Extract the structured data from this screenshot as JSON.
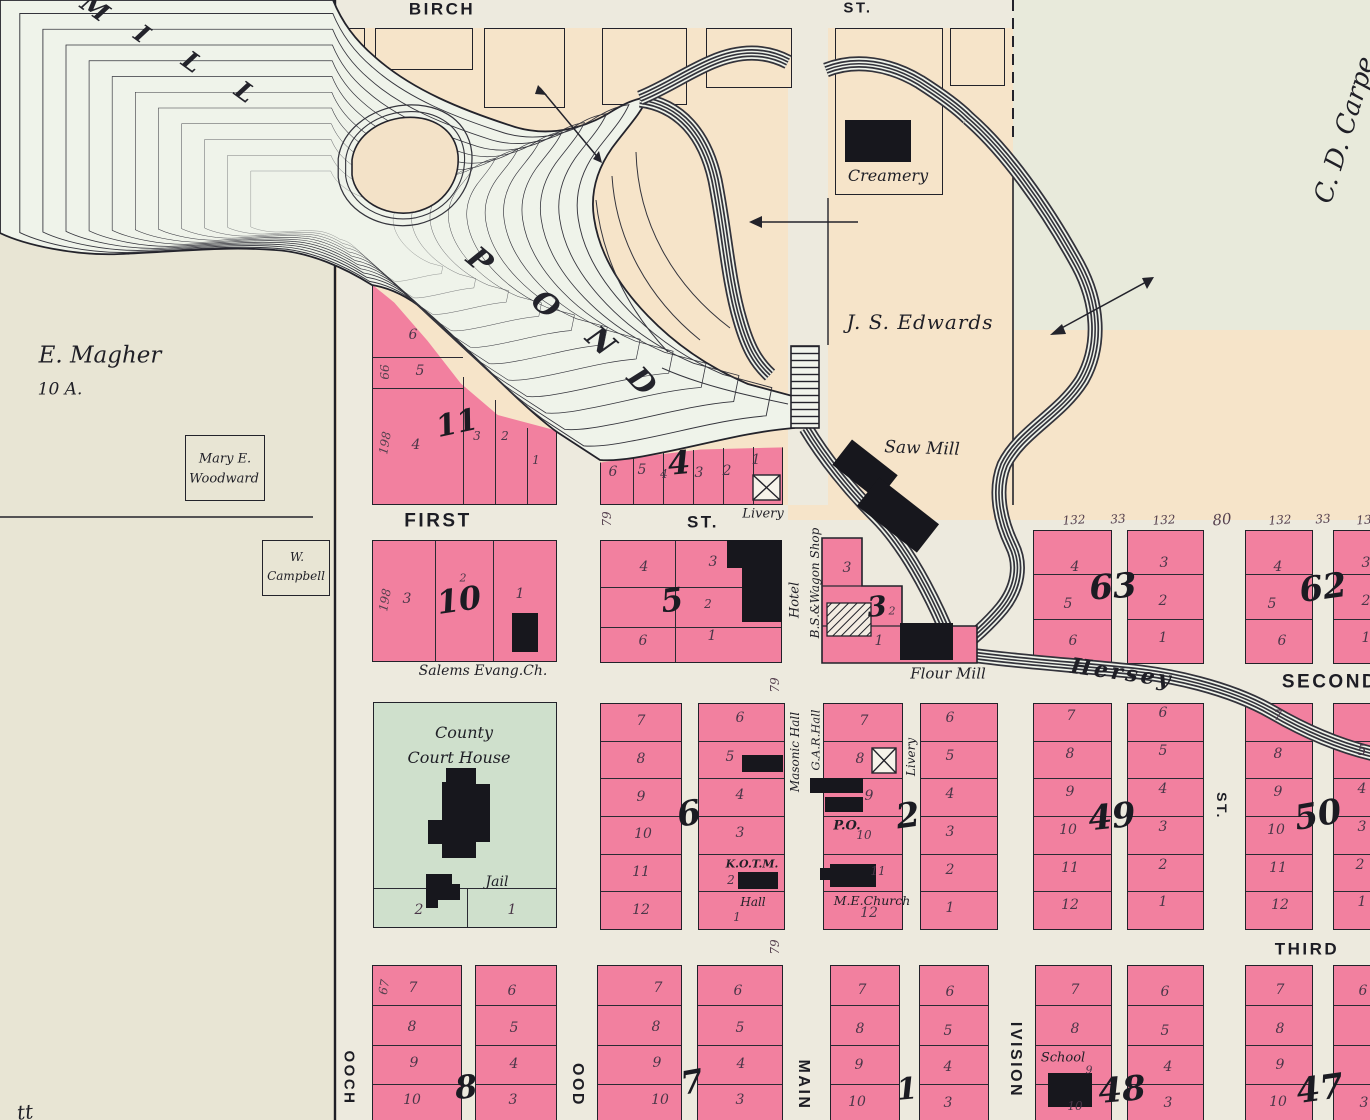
{
  "palette": {
    "pink": "#f2809f",
    "peach": "#f6e4c9",
    "green_block": "#cfe0cc",
    "left_land": "#e8e5d4",
    "street": "#edeade",
    "carpenter_land": "#e8eadb",
    "water": "#eff3ea",
    "ink": "#23232b"
  },
  "streets": {
    "birch": "BIRCH",
    "birch_st": "ST.",
    "first": "FIRST",
    "first_st": "ST.",
    "second": "SECOND",
    "third": "THIRD",
    "main": "MAIN",
    "wood": "OOD",
    "division": "IVISION",
    "west": "OOCH",
    "mid_st": "ST."
  },
  "owners": {
    "magher": "E. Magher",
    "acres": "10 A.",
    "woodward_1": "Mary E.",
    "woodward_2": "Woodward",
    "campbell_1": "W.",
    "campbell_2": "Campbell",
    "edwards": "J. S. Edwards",
    "carpenter": "C. D. Carpe",
    "corner": "tt"
  },
  "water": {
    "mill": [
      "M",
      "I",
      "L",
      "L"
    ],
    "pond": [
      "P",
      "O",
      "N",
      "D"
    ],
    "creek": "Hersey"
  },
  "landmarks": {
    "creamery": "Creamery",
    "saw_mill": "Saw Mill",
    "flour_mill": "Flour Mill",
    "salems": "Salems Evang.Ch.",
    "county_1": "County",
    "county_2": "Court House",
    "jail": "Jail",
    "hotel": "Hotel",
    "wagon_shop": "B.S.&Wagon Shop",
    "livery_a": "Livery",
    "livery_b": "Livery",
    "masonic": "Masonic Hall",
    "gar": "G.A.R.Hall",
    "kotm": "K.O.T.M.",
    "kotm_hall": "Hall",
    "po": "P.O.",
    "me_church": "M.E.Church",
    "school": "School"
  },
  "dims": {
    "a198": "198",
    "a66": "66",
    "b198": "198",
    "f79": "79",
    "m79": "79",
    "t79": "79",
    "c67": "67",
    "top_row": [
      "132",
      "33",
      "132",
      "80",
      "132",
      "33",
      "13"
    ]
  },
  "blocks": {
    "b11": {
      "n": "11",
      "lots": [
        "6",
        "5",
        "4",
        "3",
        "2",
        "1"
      ]
    },
    "b4": {
      "n": "4",
      "lots": [
        "6",
        "5",
        "4",
        "3",
        "2",
        "1"
      ]
    },
    "b10": {
      "n": "10",
      "s2": "2",
      "lots": [
        "3",
        "1"
      ]
    },
    "b5": {
      "n": "5",
      "lots": [
        "4",
        "3",
        "2",
        "6",
        "1"
      ]
    },
    "b3": {
      "n": "3",
      "s2": "2",
      "lots": [
        "3",
        "1"
      ]
    },
    "b63": {
      "n": "63",
      "left": [
        "4",
        "5",
        "6"
      ],
      "right": [
        "3",
        "2",
        "1"
      ]
    },
    "b62": {
      "n": "62",
      "left": [
        "4",
        "5",
        "6"
      ],
      "right": [
        "3",
        "2",
        "1"
      ]
    },
    "bcourt": {
      "lots": [
        "2",
        "1"
      ]
    },
    "b6": {
      "n": "6",
      "left": [
        "7",
        "8",
        "9",
        "10",
        "11",
        "12"
      ],
      "right": [
        "6",
        "5",
        "4",
        "3",
        "2",
        "1"
      ]
    },
    "b2": {
      "n": "2",
      "left": [
        "7",
        "8",
        "9",
        "10",
        "11",
        "12"
      ],
      "right": [
        "6",
        "5",
        "4",
        "3",
        "2",
        "1"
      ]
    },
    "b49": {
      "n": "49",
      "left": [
        "7",
        "8",
        "9",
        "10",
        "11",
        "12"
      ],
      "right": [
        "6",
        "5",
        "4",
        "3",
        "2",
        "1"
      ]
    },
    "b50": {
      "n": "50",
      "left": [
        "7",
        "8",
        "9",
        "10",
        "11",
        "12"
      ],
      "right": [
        "5",
        "4",
        "3",
        "2",
        "1"
      ]
    },
    "b8": {
      "n": "8",
      "left": [
        "7",
        "8",
        "9",
        "10"
      ],
      "right": [
        "6",
        "5",
        "4",
        "3"
      ]
    },
    "b7": {
      "n": "7",
      "left": [
        "7",
        "8",
        "9",
        "10"
      ],
      "right": [
        "6",
        "5",
        "4",
        "3"
      ]
    },
    "b1": {
      "n": "1",
      "left": [
        "7",
        "8",
        "9",
        "10"
      ],
      "right": [
        "6",
        "5",
        "4",
        "3"
      ]
    },
    "b48": {
      "n": "48",
      "left": [
        "7",
        "8",
        "9",
        "10"
      ],
      "right": [
        "6",
        "5",
        "4",
        "3"
      ]
    },
    "b47": {
      "n": "47",
      "left": [
        "7",
        "8",
        "9",
        "10"
      ],
      "right": [
        "6",
        "3"
      ]
    }
  }
}
